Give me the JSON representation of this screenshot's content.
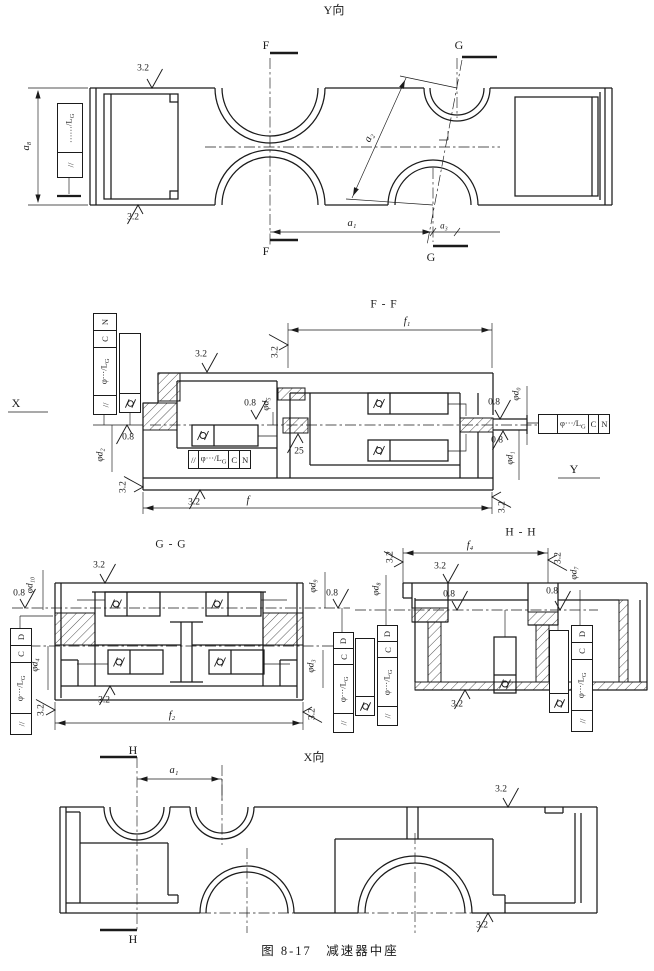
{
  "caption": "图 8-17　减速器中座",
  "labels": {
    "view_y": "Y向",
    "view_x": "X向",
    "sec_ff": "F - F",
    "sec_gg": "G - G",
    "sec_hh": "H - H",
    "f": "F",
    "g": "G",
    "h": "H",
    "axis_x": "X",
    "axis_y": "Y"
  },
  "dims": {
    "a_total": "a₈",
    "a1": "a₁",
    "a2": "a₂",
    "a3": "a₃",
    "f": "f",
    "f1": "f₁",
    "f2": "f₂",
    "f4": "f₄",
    "d0": "φd₀",
    "d1": "φd₁",
    "d2": "φd₂",
    "d3": "φd₃",
    "d4": "φd₄",
    "d5": "φd₅",
    "d7": "φd₇",
    "d8": "φd₈",
    "d9": "φd₉",
    "d10": "φd₁₀"
  },
  "roughness": {
    "r32": "3.2",
    "r08": "0.8",
    "r25": "25"
  },
  "fcf": {
    "parallel": "//",
    "value_main": "φ···/L",
    "value_sub": "G",
    "value_dots_main": "……/L",
    "value_dots_sub": "G",
    "datum_c": "C",
    "datum_n": "N",
    "datum_d": "D"
  },
  "icons": {
    "cylindricity": "cylindricity-icon",
    "roughness": "surface-roughness-icon"
  },
  "colors": {
    "ink": "#1b1b1b",
    "paper": "#ffffff"
  }
}
